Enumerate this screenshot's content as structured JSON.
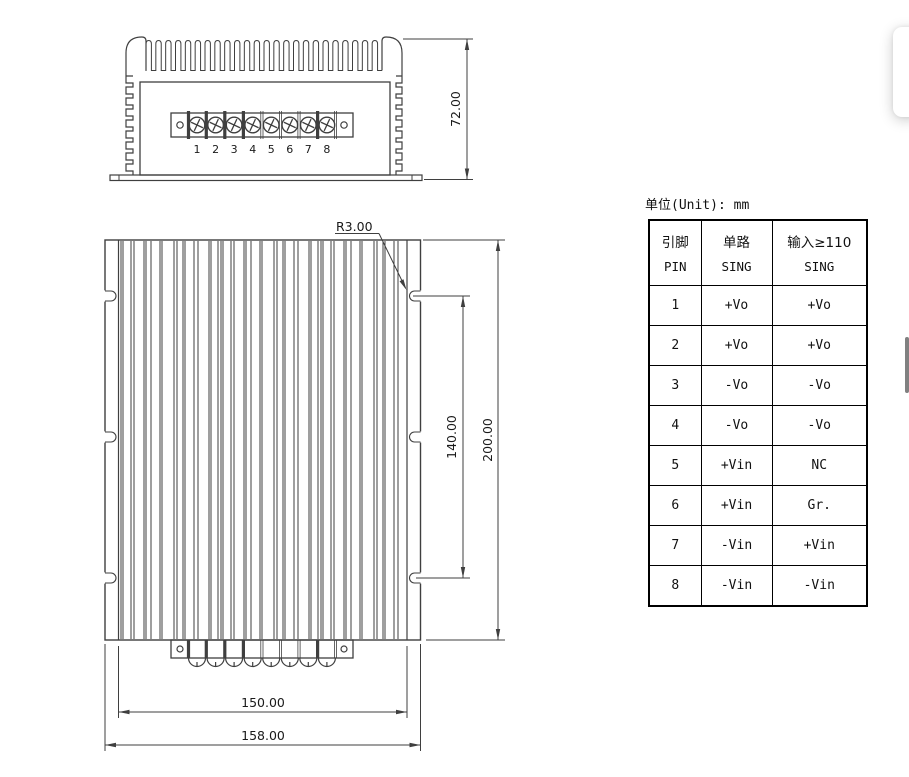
{
  "colors": {
    "line": "#3f3f3f",
    "text": "#1a1a1a",
    "scrollbar_thumb": "#808080"
  },
  "unit_label": "单位(Unit): mm",
  "front_view": {
    "height_dim": "72.00",
    "pin_numbers": [
      "1",
      "2",
      "3",
      "4",
      "5",
      "6",
      "7",
      "8"
    ]
  },
  "top_view": {
    "radius_label": "R3.00",
    "inner_height_dim": "140.00",
    "outer_height_dim": "200.00",
    "inner_width_dim": "150.00",
    "outer_width_dim": "158.00"
  },
  "pin_table": {
    "headers": [
      {
        "line1": "引脚",
        "line2": "PIN"
      },
      {
        "line1": "单路",
        "line2": "SING"
      },
      {
        "line1": "输入≥110",
        "line2": "SING"
      }
    ],
    "rows": [
      {
        "pin": "1",
        "sing": "+Vo",
        "input110": "+Vo"
      },
      {
        "pin": "2",
        "sing": "+Vo",
        "input110": "+Vo"
      },
      {
        "pin": "3",
        "sing": "-Vo",
        "input110": "-Vo"
      },
      {
        "pin": "4",
        "sing": "-Vo",
        "input110": "-Vo"
      },
      {
        "pin": "5",
        "sing": "+Vin",
        "input110": "NC"
      },
      {
        "pin": "6",
        "sing": "+Vin",
        "input110": "Gr."
      },
      {
        "pin": "7",
        "sing": "-Vin",
        "input110": "+Vin"
      },
      {
        "pin": "8",
        "sing": "-Vin",
        "input110": "-Vin"
      }
    ]
  }
}
